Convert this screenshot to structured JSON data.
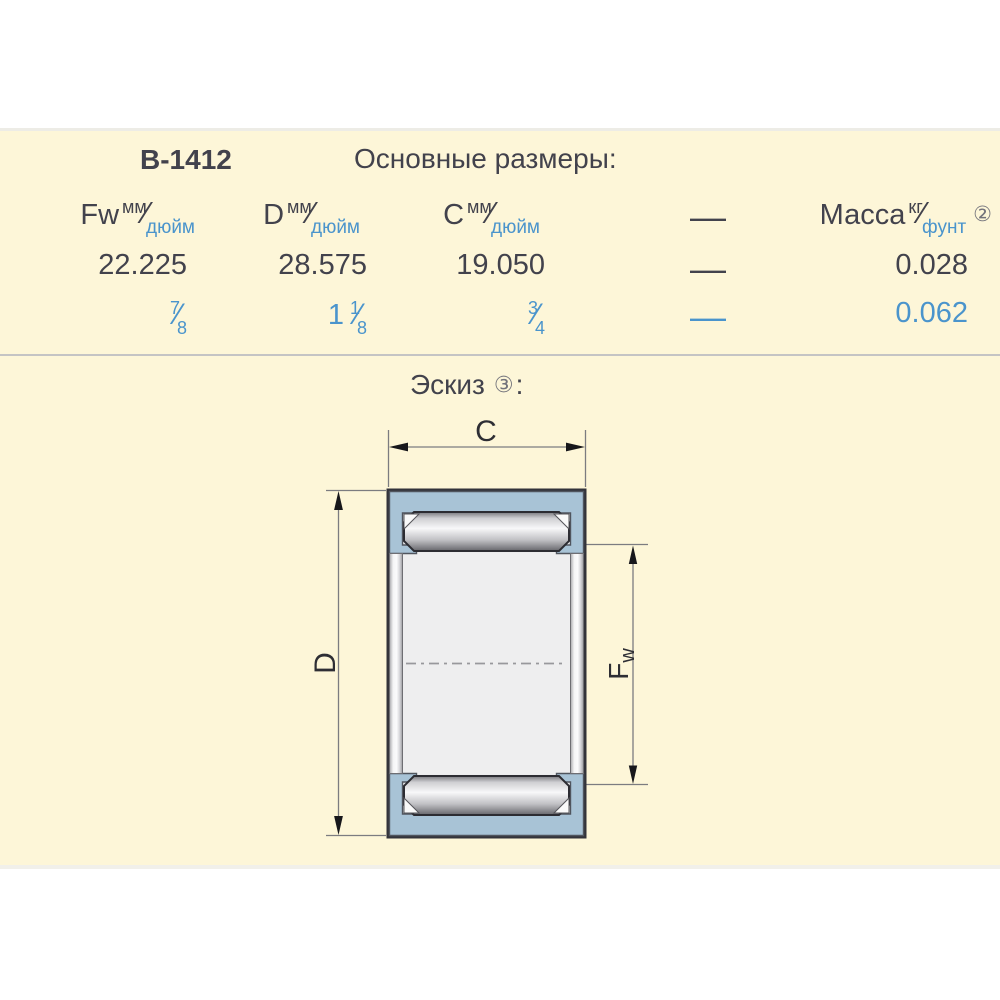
{
  "header": {
    "part_number": "B-1412",
    "section_title": "Основные размеры:"
  },
  "table": {
    "slash": "⁄",
    "columns": [
      {
        "symbol": "Fw",
        "unit_top": "мм",
        "unit_bottom": "дюйм"
      },
      {
        "symbol": "D",
        "unit_top": "мм",
        "unit_bottom": "дюйм"
      },
      {
        "symbol": "C",
        "unit_top": "мм",
        "unit_bottom": "дюйм"
      },
      {
        "symbol": "—"
      },
      {
        "symbol": "Масса",
        "unit_top": "кг",
        "unit_bottom": "фунт",
        "footnote": "②"
      }
    ],
    "row_mm": {
      "fw": "22.225",
      "d": "28.575",
      "c": "19.050",
      "dash": "—",
      "mass": "0.028"
    },
    "row_inch": {
      "fw": {
        "whole": "",
        "num": "7",
        "den": "8"
      },
      "d": {
        "whole": "1",
        "num": "1",
        "den": "8"
      },
      "c": {
        "whole": "",
        "num": "3",
        "den": "4"
      },
      "dash": "—",
      "mass": "0.062"
    }
  },
  "sketch": {
    "title": "Эскиз",
    "footnote": "③",
    "colon": ":",
    "labels": {
      "c": "C",
      "d": "D",
      "fw_main": "F",
      "fw_sub": "w"
    }
  },
  "colors": {
    "text_dark": "#42424c",
    "accent_blue": "#4a94cc",
    "background_cream": "#fdf6d8",
    "shell_blue": "#a8c3d6"
  }
}
